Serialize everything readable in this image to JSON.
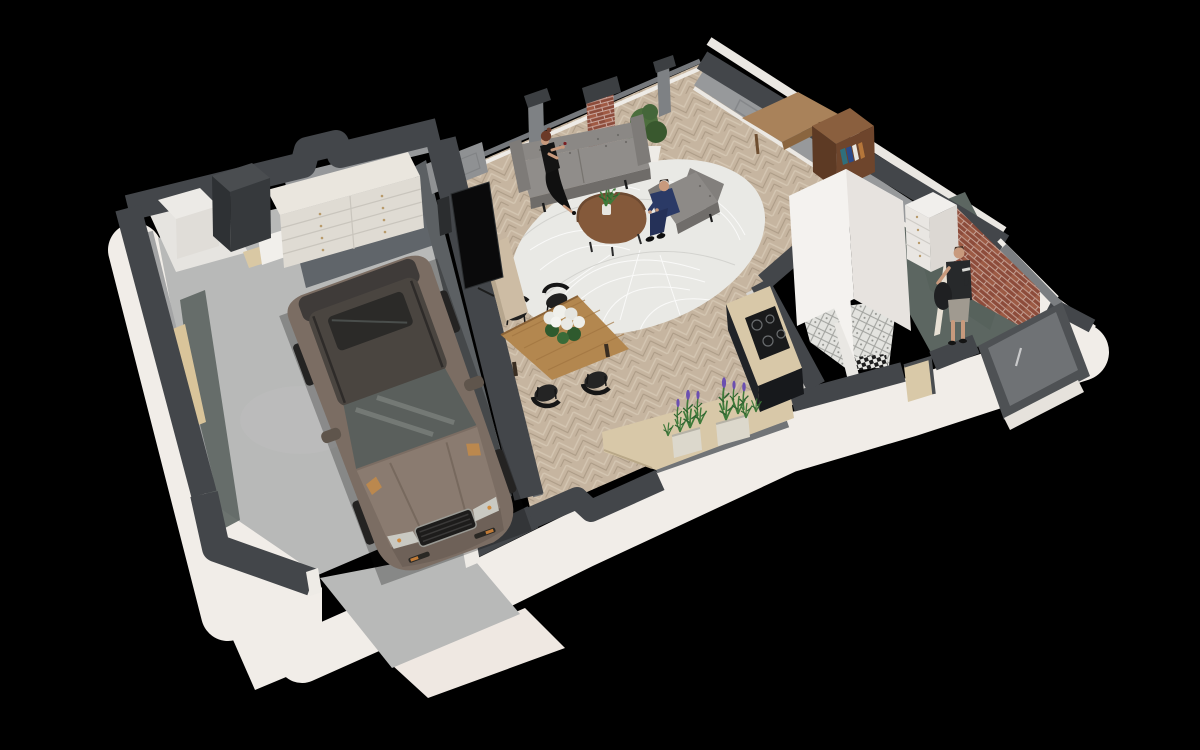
{
  "scene": {
    "title": "isometric-3d-floor-plan-render",
    "view": "isometric-cutaway-top",
    "background": "black",
    "rooms": [
      {
        "name": "garage",
        "floor": "concrete-gray",
        "contents": [
          "brown-suv",
          "white-storage-sideboard",
          "utility-cabinet",
          "side-door",
          "interior-door"
        ]
      },
      {
        "name": "storage-room",
        "floor": "white",
        "contents": [
          "white-cabinet",
          "dark-utility-unit"
        ]
      },
      {
        "name": "living-room",
        "floor": "herringbone-oak",
        "contents": [
          "gray-sofa",
          "gray-armchair",
          "round-white-leaf-rug",
          "walnut-coffee-table",
          "vase-greenery",
          "floor-plant",
          "tv-media-console",
          "speaker",
          "brick-chimney-column",
          "window-pillars"
        ]
      },
      {
        "name": "dining-area",
        "floor": "herringbone-oak",
        "contents": [
          "oak-dining-table",
          "black-spindle-chairs",
          "white-hydrangea-bouquet"
        ]
      },
      {
        "name": "kitchen",
        "floor": "herringbone-oak",
        "contents": [
          "l-shaped-counter",
          "dark-base-cabinets",
          "induction-cooktop",
          "window-sill-counter",
          "lavender-planters"
        ]
      },
      {
        "name": "bathroom",
        "floor": "moroccan-tile",
        "contents": [
          "black-white-mosaic-border",
          "white-partition-walls"
        ]
      },
      {
        "name": "hallway-entry",
        "floor": "sage-green",
        "contents": [
          "brick-accent-wall",
          "white-dresser",
          "front-door",
          "open-door-leaf",
          "window-niche"
        ]
      },
      {
        "name": "office-corner",
        "floor": "herringbone-oak",
        "contents": [
          "corner-desk",
          "walnut-bookshelf",
          "books",
          "tall-white-cabinet"
        ]
      }
    ],
    "people": [
      {
        "name": "woman-on-sofa",
        "pose": "sitting",
        "clothing": "black-evening-dress",
        "holding": "wine-glass",
        "hair": "auburn-updo"
      },
      {
        "name": "man-in-armchair",
        "pose": "sitting-leaning-forward",
        "clothing": "navy-suit",
        "hair": "dark-brown"
      },
      {
        "name": "man-in-hallway",
        "pose": "standing",
        "clothing": "dark-tshirt-gray-shorts",
        "holding": "black-bag",
        "hair": "brown"
      }
    ],
    "vehicle": {
      "name": "suv",
      "color": "bronze-brown",
      "roof": "dark-gray",
      "features": [
        "sunroof",
        "chrome-grille",
        "orange-drl-accents"
      ],
      "location": "garage"
    }
  },
  "palette": {
    "bg": "#000000",
    "wall_top": "#43464a",
    "wall_white": "#f1ede8",
    "wall_gray": "#97999b",
    "floor_wood": "#c6b5a0",
    "floor_concrete": "#b8b9b8",
    "floor_sage": "#5c6661",
    "floor_tile": "#e3e3df",
    "rug": "#e9e9e5",
    "sofa_gray": "#8b8885",
    "walnut": "#84593a",
    "oak": "#b3874f",
    "counter_wood": "#d8c8a8",
    "cabinet_dark": "#22252a",
    "brick": "#8d4c3b",
    "car_body": "#7b6d63",
    "car_roof": "#4a4540",
    "glass": "#5a5f5c",
    "plant_green": "#3f7a3a",
    "lavender": "#7a5cc6",
    "furniture_white": "#efece8",
    "door_gray": "#6f7275",
    "skin": "#c89a7d",
    "suit_navy": "#2b3a66"
  }
}
